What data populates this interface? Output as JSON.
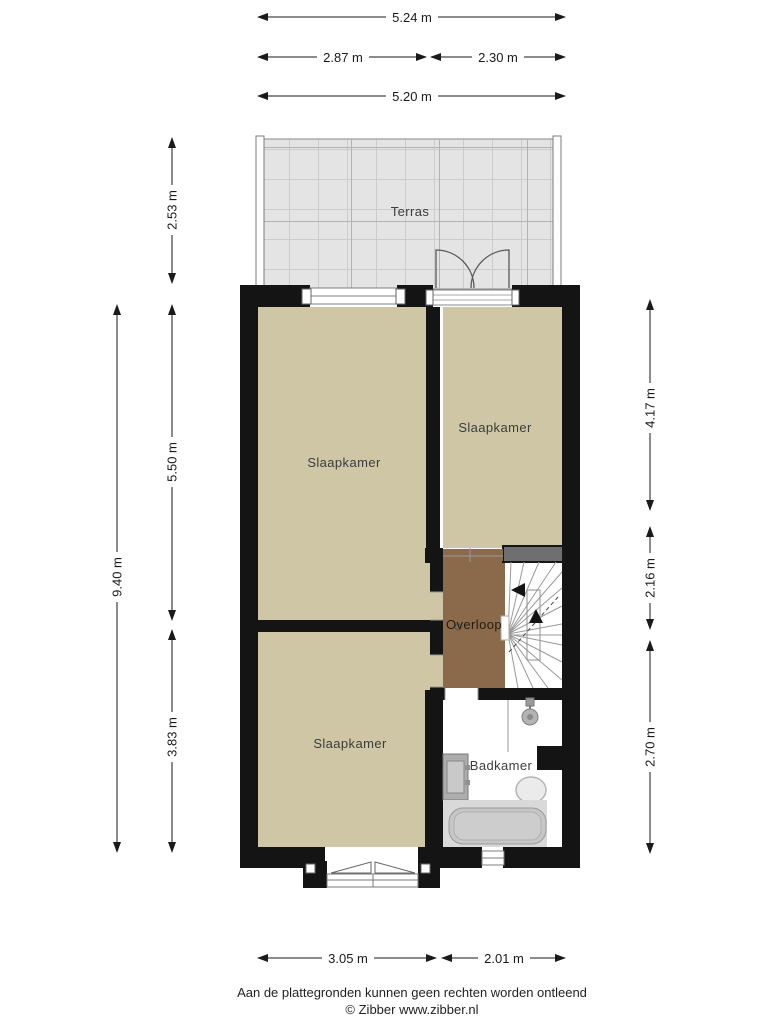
{
  "title": "Floor plan (plattegrond) - verdieping",
  "colors": {
    "wall": "#141414",
    "room_floor": "#cfc6a6",
    "landing_floor": "#8a6a4b",
    "terrace_floor": "#e4e4e4",
    "terrace_grid": "#c6c6c6",
    "stair_top_wall_gray": "#6f6f6f",
    "fixture_gray": "#c6c6c6",
    "dimension_line": "#1a1a1a"
  },
  "rooms": {
    "terrace": {
      "label": "Terras"
    },
    "bedroom_top_left": {
      "label": "Slaapkamer"
    },
    "bedroom_top_right": {
      "label": "Slaapkamer"
    },
    "bedroom_bottom": {
      "label": "Slaapkamer"
    },
    "landing": {
      "label": "Overloop"
    },
    "bathroom": {
      "label": "Badkamer"
    }
  },
  "fixtures": {
    "shower": "shower-head-icon",
    "sink": "sink-icon",
    "toilet": "toilet-icon",
    "bathtub": "bathtub-icon",
    "stairs": "winder-staircase",
    "french_doors": "double-door-swing"
  },
  "dimensions": {
    "top_total": "5.24 m",
    "top_left": "2.87 m",
    "top_right": "2.30 m",
    "top_inner": "5.20 m",
    "left_terrace": "2.53 m",
    "left_total": "9.40 m",
    "left_upper": "5.50 m",
    "left_lower": "3.83 m",
    "right_upper": "4.17 m",
    "right_middle": "2.16 m",
    "right_lower": "2.70 m",
    "bottom_left": "3.05 m",
    "bottom_right": "2.01 m"
  },
  "footer": {
    "disclaimer": "Aan de plattegronden kunnen geen rechten worden ontleend",
    "copyright": "© Zibber www.zibber.nl"
  }
}
